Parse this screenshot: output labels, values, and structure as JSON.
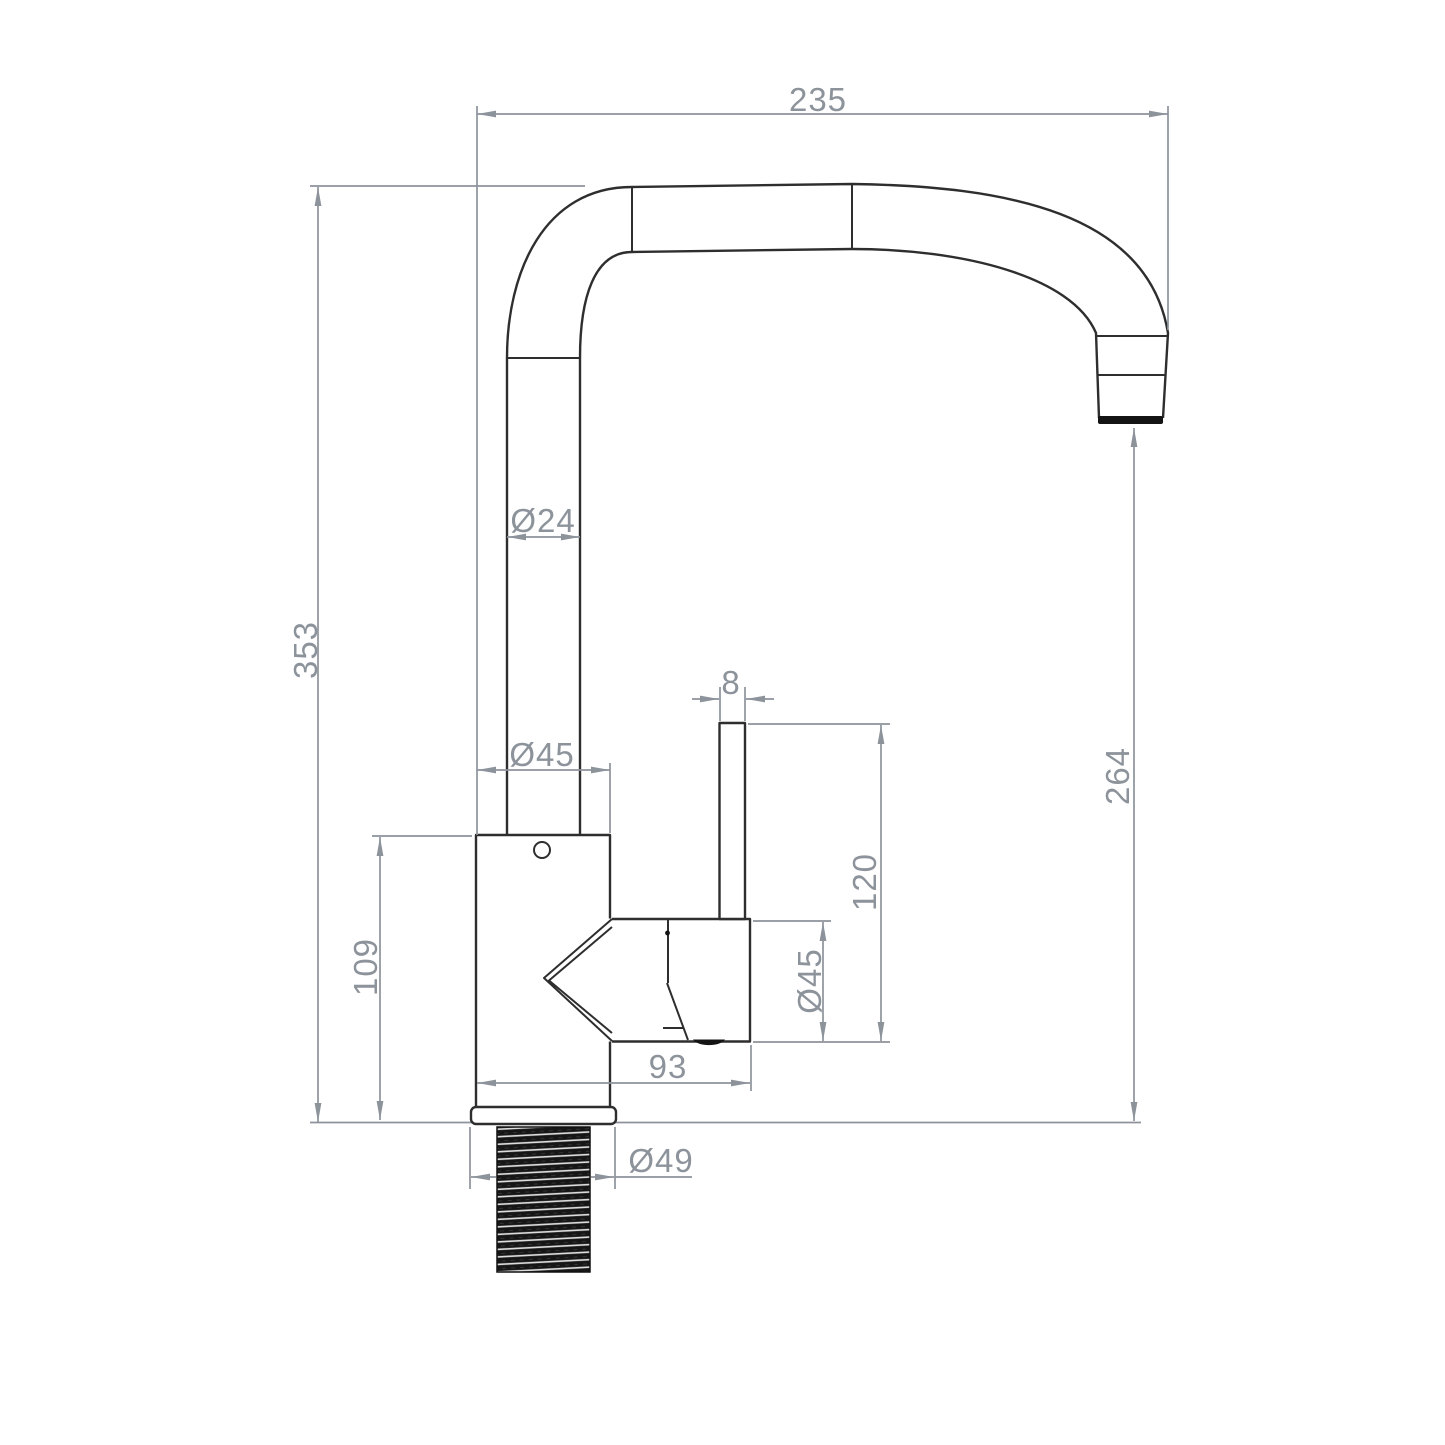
{
  "page": {
    "background": "#ffffff"
  },
  "drawing": {
    "type": "technical-dimension-drawing",
    "subject": "kitchen-mixer-tap-side-view",
    "object_line_color": "#2e2e2e",
    "dimension_color": "#8d939b",
    "dims": {
      "spout_reach": "235",
      "overall_height": "353",
      "spout_tube_diameter": "Ø24",
      "body_diameter": "Ø45",
      "lever_thickness": "8",
      "outlet_height": "264",
      "lever_height": "120",
      "valve_diameter": "Ø45",
      "body_height": "109",
      "body_length": "93",
      "flange_diameter": "Ø49"
    }
  }
}
